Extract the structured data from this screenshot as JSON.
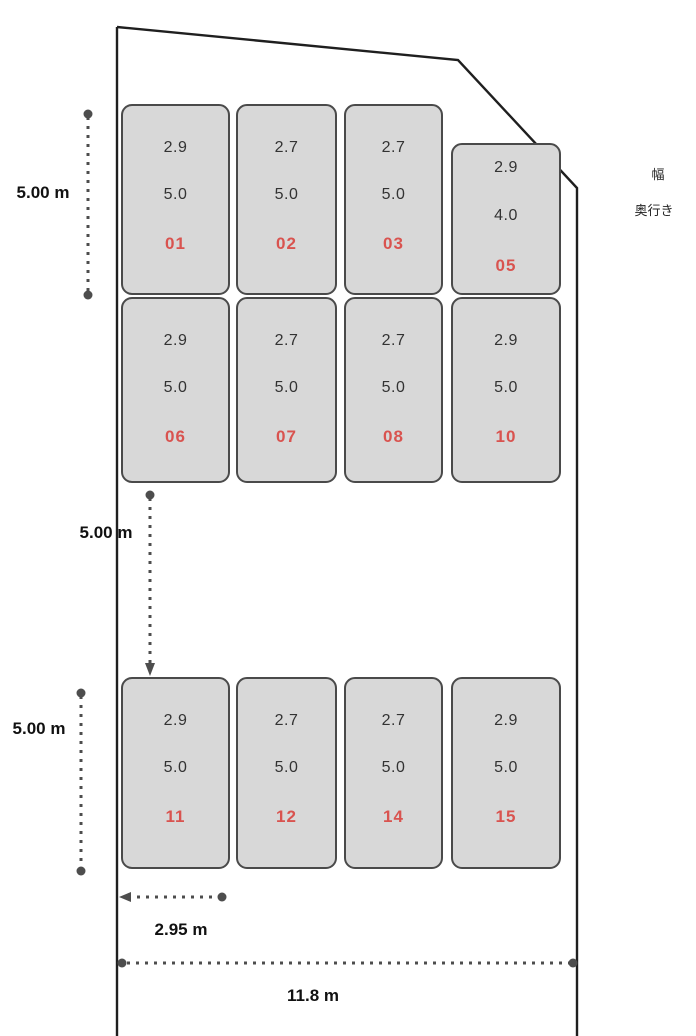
{
  "legend": {
    "width_label": "幅",
    "depth_label": "奥行き"
  },
  "dimensions": {
    "row1_height": "5.00 m",
    "aisle_height": "5.00 m",
    "row3_height": "5.00 m",
    "spot_width": "2.95 m",
    "site_width": "11.8 m"
  },
  "spots": [
    {
      "number": "01",
      "width_m": "2.9",
      "depth_m": "5.0",
      "row": 0,
      "col": 0,
      "short": false
    },
    {
      "number": "02",
      "width_m": "2.7",
      "depth_m": "5.0",
      "row": 0,
      "col": 1,
      "short": false
    },
    {
      "number": "03",
      "width_m": "2.7",
      "depth_m": "5.0",
      "row": 0,
      "col": 2,
      "short": false
    },
    {
      "number": "05",
      "width_m": "2.9",
      "depth_m": "4.0",
      "row": 0,
      "col": 3,
      "short": true
    },
    {
      "number": "06",
      "width_m": "2.9",
      "depth_m": "5.0",
      "row": 1,
      "col": 0,
      "short": false
    },
    {
      "number": "07",
      "width_m": "2.7",
      "depth_m": "5.0",
      "row": 1,
      "col": 1,
      "short": false
    },
    {
      "number": "08",
      "width_m": "2.7",
      "depth_m": "5.0",
      "row": 1,
      "col": 2,
      "short": false
    },
    {
      "number": "10",
      "width_m": "2.9",
      "depth_m": "5.0",
      "row": 1,
      "col": 3,
      "short": false
    },
    {
      "number": "11",
      "width_m": "2.9",
      "depth_m": "5.0",
      "row": 2,
      "col": 0,
      "short": false
    },
    {
      "number": "12",
      "width_m": "2.7",
      "depth_m": "5.0",
      "row": 2,
      "col": 1,
      "short": false
    },
    {
      "number": "14",
      "width_m": "2.7",
      "depth_m": "5.0",
      "row": 2,
      "col": 2,
      "short": false
    },
    {
      "number": "15",
      "width_m": "2.9",
      "depth_m": "5.0",
      "row": 2,
      "col": 3,
      "short": false
    }
  ],
  "colors": {
    "spot_fill": "#d8d8d8",
    "spot_border": "#4a4a4a",
    "spot_number_red": "#d9534f",
    "boundary_line": "#1f1f1f",
    "dimension_line": "#4d4d4d"
  }
}
